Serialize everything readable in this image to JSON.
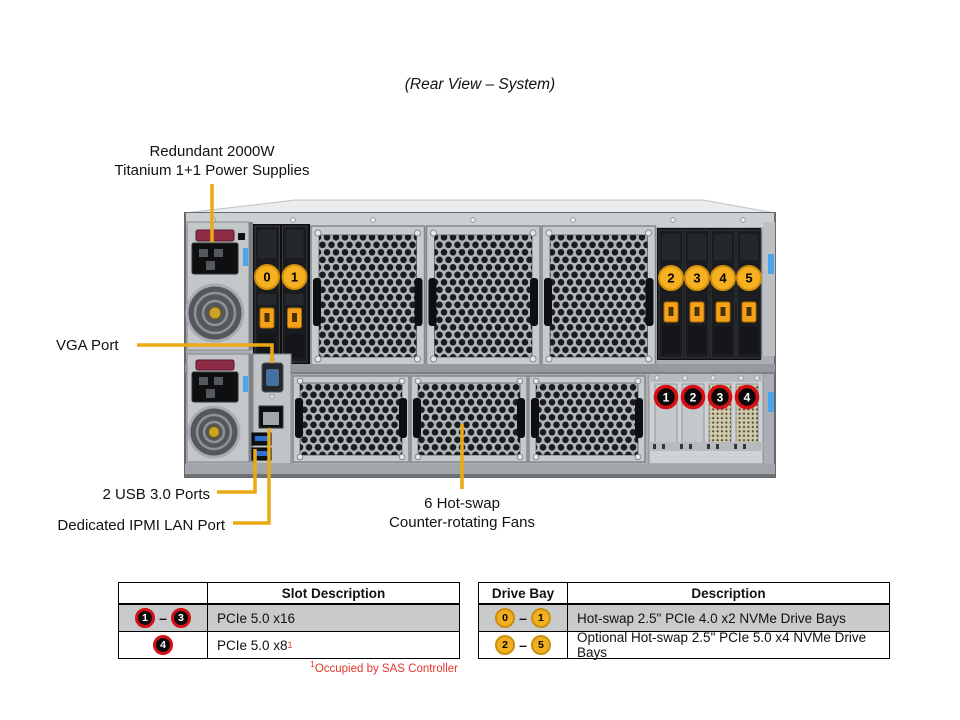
{
  "title": "(Rear View – System)",
  "callouts": {
    "psu_line1": "Redundant 2000W",
    "psu_line2": "Titanium 1+1 Power Supplies",
    "vga": "VGA Port",
    "usb": "2 USB 3.0 Ports",
    "ipmi": "Dedicated IPMI LAN Port",
    "fans_line1": "6 Hot-swap",
    "fans_line2": "Counter-rotating Fans"
  },
  "glyphs": {
    "dash": "–"
  },
  "chassis": {
    "drive_bays_front": [
      "0",
      "1"
    ],
    "drive_bays_rear": [
      "2",
      "3",
      "4",
      "5"
    ],
    "pcie_slots": [
      "1",
      "2",
      "3",
      "4"
    ]
  },
  "slot_table": {
    "header_col2": "Slot Description",
    "row1": {
      "b1": "1",
      "b2": "3",
      "desc": "PCIe 5.0 x16"
    },
    "row2": {
      "b": "4",
      "desc": "PCIe 5.0 x8",
      "sup": "1"
    },
    "footnote_sup": "1",
    "footnote": "Occupied by SAS Controller"
  },
  "drive_table": {
    "header_col1": "Drive Bay",
    "header_col2": "Description",
    "row1": {
      "b1": "0",
      "b2": "1",
      "desc": "Hot-swap 2.5\" PCIe 4.0 x2 NVMe Drive Bays"
    },
    "row2": {
      "b1": "2",
      "b2": "5",
      "desc": "Optional Hot-swap 2.5\" PCIe 5.0 x4 NVMe Drive Bays"
    }
  },
  "colors": {
    "callout_line": "#EAAA12",
    "drive_badge_gold": "#F2B01E",
    "drive_badge_ring": "#C98E12",
    "pcie_badge_ring": "#D50F14",
    "footnote_red": "#E2372B",
    "table_row_gray": "#C9CACB"
  }
}
